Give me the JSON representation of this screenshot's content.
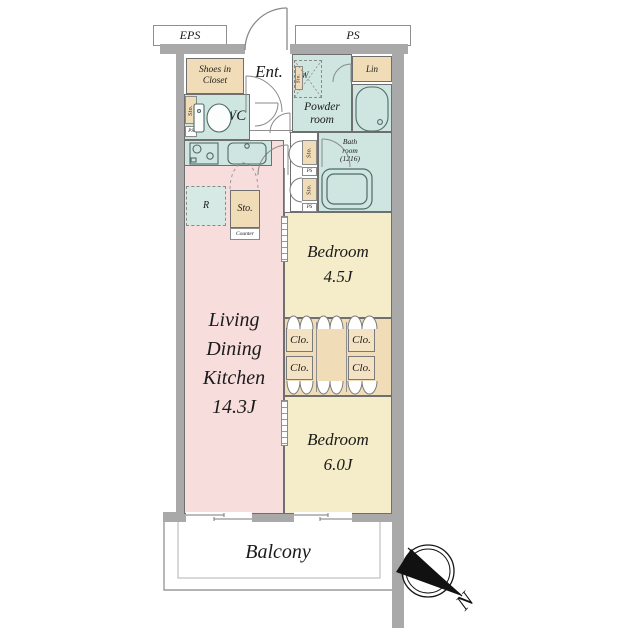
{
  "plan": {
    "eps": "EPS",
    "ps": "PS",
    "ent": "Ent.",
    "shoes": {
      "l1": "Shoes in",
      "l2": "Closet"
    },
    "wc": "WC",
    "powder": {
      "l1": "Powder",
      "l2": "room"
    },
    "lin": "Lin",
    "washer": "W",
    "bath": {
      "l1": "Bath",
      "l2": "room",
      "l3": "(1216)"
    },
    "sto": "Sto.",
    "ps_small": "PS",
    "fridge": "R",
    "counter": "Counter",
    "ldk": {
      "l1": "Living",
      "l2": "Dining",
      "l3": "Kitchen",
      "size": "14.3J"
    },
    "bedroom1": {
      "name": "Bedroom",
      "size": "4.5J"
    },
    "bedroom2": {
      "name": "Bedroom",
      "size": "6.0J"
    },
    "clo": [
      "Clo.",
      "Clo.",
      "Clo.",
      "Clo."
    ],
    "balcony": "Balcony",
    "north": "N"
  },
  "colors": {
    "wall": "#a9a9a9",
    "line": "#6f6f6f",
    "ldk": "#f8dddd",
    "bedroom": "#f5edc9",
    "wet": "#cfe5df",
    "closet": "#f0dcb6",
    "clobox": "#f3e3c4",
    "fridge": "#d6e9e5"
  }
}
